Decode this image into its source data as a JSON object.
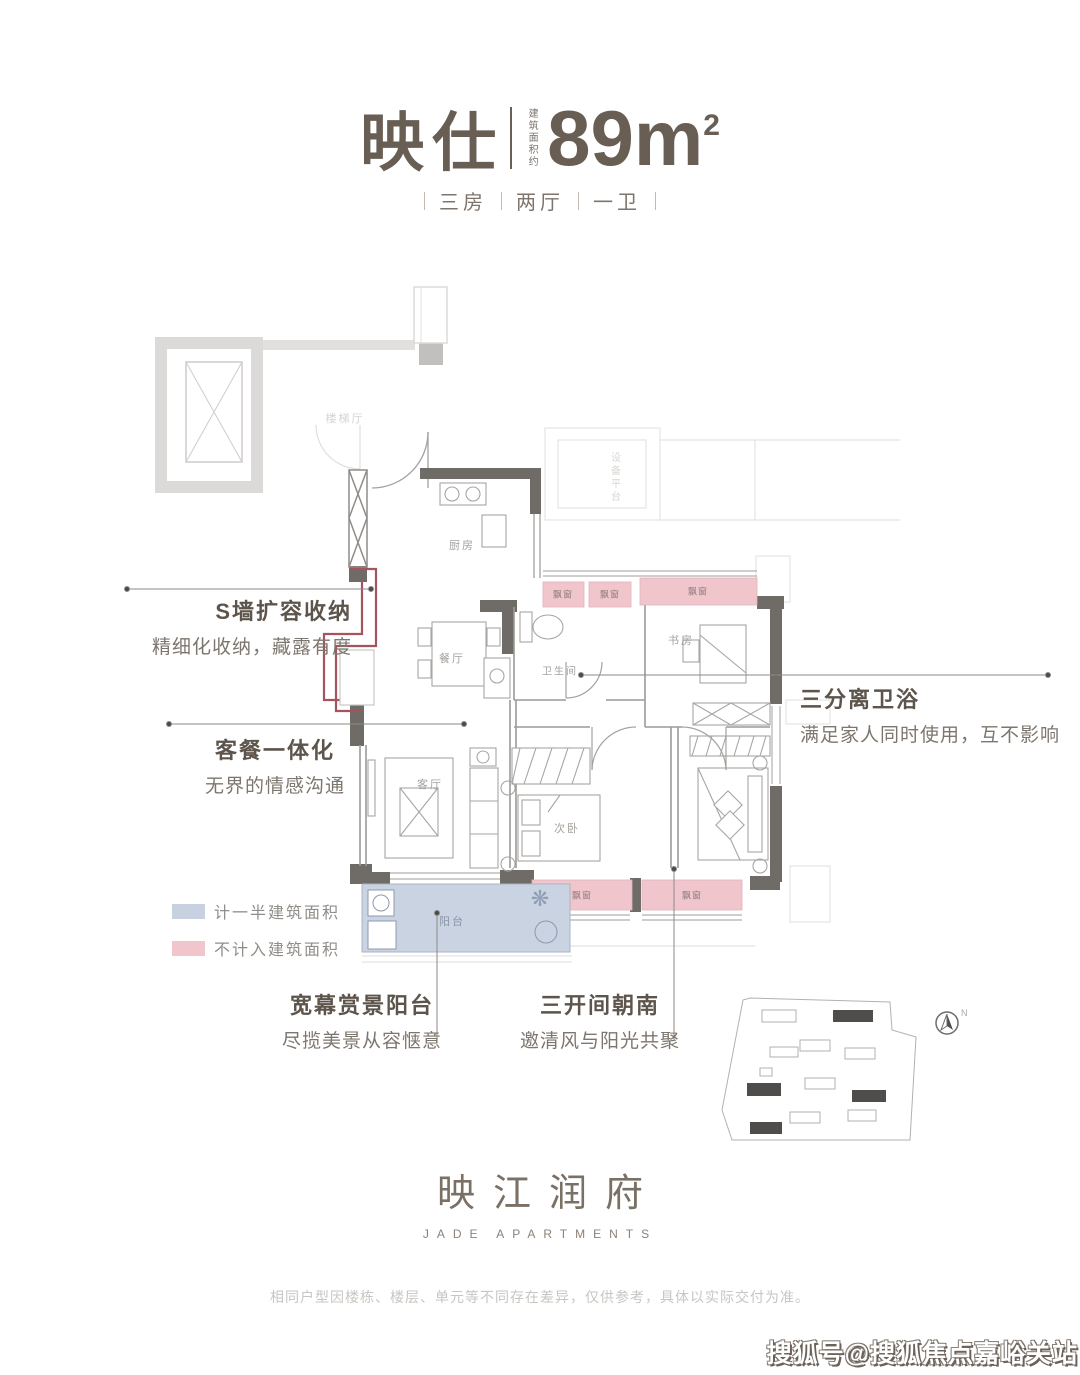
{
  "header": {
    "name": "映仕",
    "area_label_vertical": "建筑面积约",
    "area_value": "89m",
    "area_sup": "2",
    "specs": [
      "三房",
      "两厅",
      "一卫"
    ]
  },
  "plan": {
    "rooms": {
      "stair_hall": "楼梯厅",
      "equipment_platform": "设备平台",
      "kitchen": "厨房",
      "dining": "餐厅",
      "bath": "卫生间",
      "study": "书房",
      "living": "客厅",
      "bedroom2": "次卧",
      "balcony": "阳台",
      "bay_window": "飘窗"
    }
  },
  "annotations": {
    "storage": {
      "title": "S墙扩容收纳",
      "desc": "精细化收纳，藏露有度"
    },
    "living_dining": {
      "title": "客餐一体化",
      "desc": "无界的情感沟通"
    },
    "bathroom": {
      "title": "三分离卫浴",
      "desc": "满足家人同时使用，互不影响"
    },
    "balcony": {
      "title": "宽幕赏景阳台",
      "desc": "尽揽美景从容惬意"
    },
    "south_rooms": {
      "title": "三开间朝南",
      "desc": "邀清风与阳光共聚"
    }
  },
  "legend": {
    "items": [
      {
        "label": "计一半建筑面积",
        "color": "#c7d1e0"
      },
      {
        "label": "不计入建筑面积",
        "color": "#f0c5cc"
      }
    ]
  },
  "siteplan": {
    "north_label": "N"
  },
  "logo": {
    "cn": "映江润府",
    "en": "JADE APARTMENTS"
  },
  "footer": {
    "disclaimer": "相同户型因楼栋、楼层、单元等不同存在差异，仅供参考，具体以实际交付为准。"
  },
  "watermark": "搜狐号@搜狐焦点嘉峪关站",
  "colors": {
    "title_ink": "#695e54",
    "wall_dark": "#6f6b66",
    "wall_public": "#dcdad8",
    "bay_window_pink": "#f0c5cc",
    "balcony_blue": "#c9d3e1",
    "s_wall_red": "#a5535e"
  }
}
